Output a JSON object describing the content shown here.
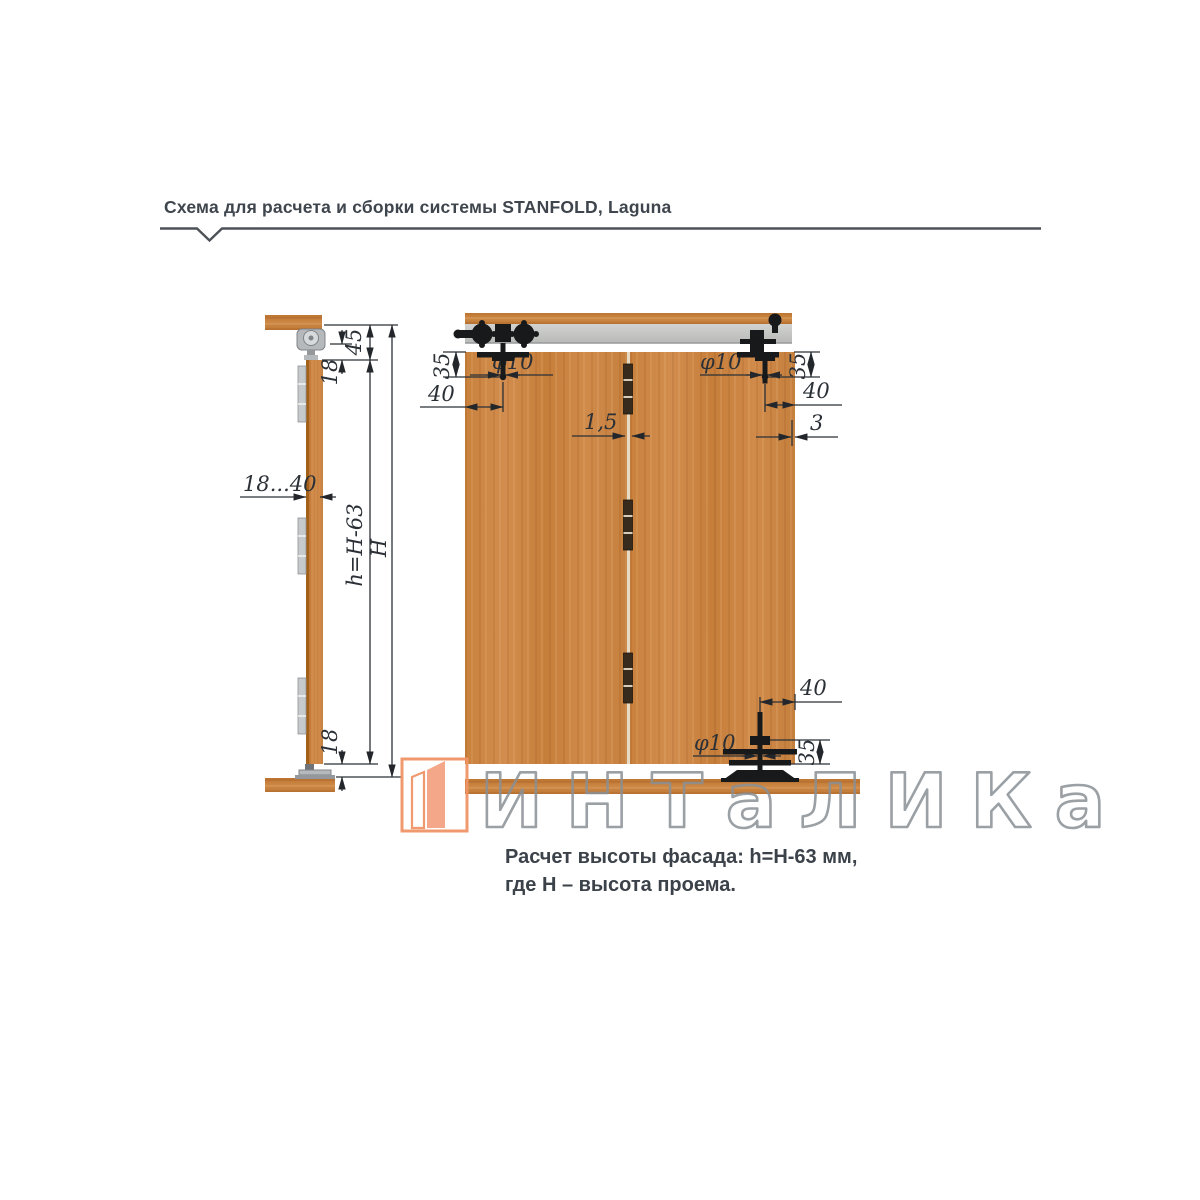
{
  "document": {
    "title": "Схема для расчета и сборки системы STANFOLD, Laguna",
    "caption": {
      "line1": "Расчет высоты фасада: h=H-63 мм,",
      "line2": "где H – высота проема."
    },
    "watermark": "ИНТаЛИКа"
  },
  "side_view": {
    "label": "side-view-of-folding-door-system",
    "dims": {
      "top_clearance": "45",
      "top_gap": "18",
      "door_thickness": "18...40",
      "door_height": "h=H-63",
      "opening_height": "H",
      "bottom_gap": "18"
    }
  },
  "front_view": {
    "label": "front-view-of-two-door-panels",
    "dims": {
      "tl_v35": "35",
      "tl_h40": "40",
      "tl_dia": "φ10",
      "panel_gap": "1,5",
      "tr_v35": "35",
      "tr_h40": "40",
      "tr_dia": "φ10",
      "edge_gap": "3",
      "br_h40": "40",
      "br_v35": "35",
      "br_dia": "φ10"
    }
  },
  "colors": {
    "wood": "#cd8746",
    "track_gray": "#c6c7c5",
    "hardware_black": "#17191b",
    "dim_line": "#2b3036",
    "accent_orange": "#f09468",
    "title_text": "#3f454d"
  }
}
